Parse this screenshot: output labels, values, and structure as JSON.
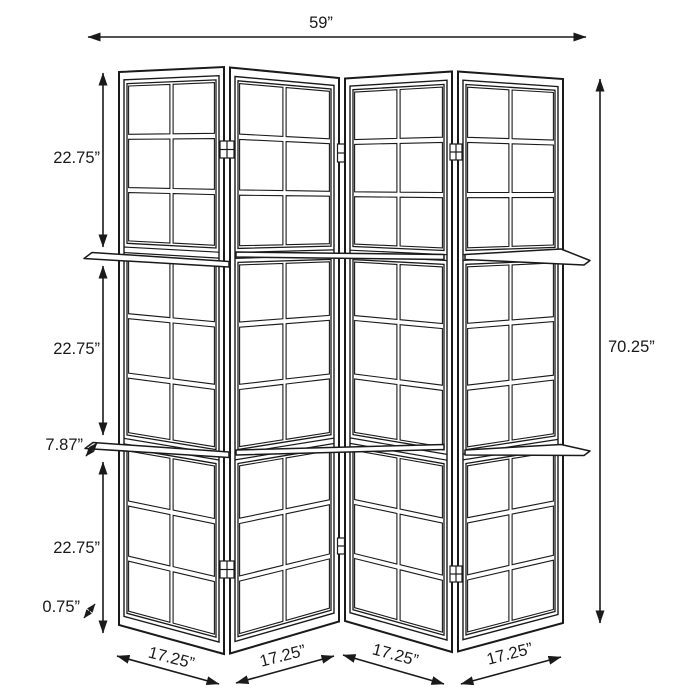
{
  "figure": {
    "panel_count": 4,
    "shelf_count": 2,
    "sections_per_panel": 3,
    "panes_per_section": 6
  },
  "colors": {
    "line": "#1a1a1a",
    "background": "#ffffff"
  },
  "dims": {
    "overall_width": "59”",
    "overall_height": "70.25”",
    "sections": {
      "top": "22.75”",
      "middle": "22.75”",
      "bottom": "22.75”"
    },
    "shelf_depth": "7.87”",
    "frame_thickness": "0.75”",
    "panel_widths": [
      "17.25”",
      "17.25”",
      "17.25”",
      "17.25”"
    ]
  }
}
